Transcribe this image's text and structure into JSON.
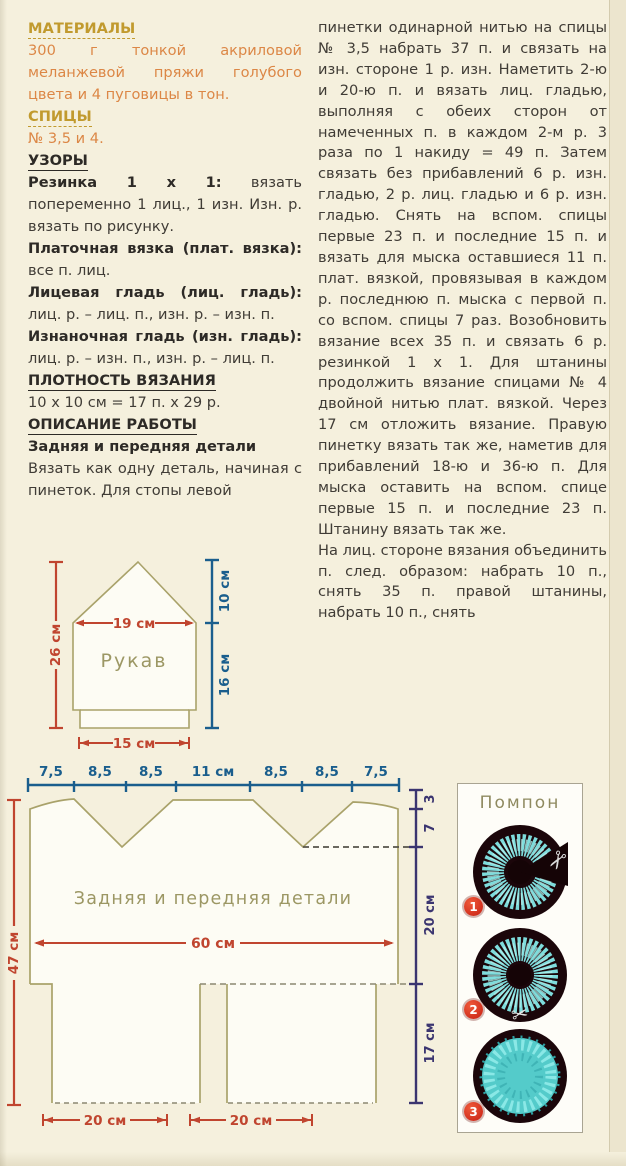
{
  "left_column": {
    "materials": {
      "title": "МАТЕРИАЛЫ",
      "body": "300 г тонкой акриловой меланжевой пряжи голубого цвета и 4 пуговицы в тон."
    },
    "needles": {
      "title": "СПИЦЫ",
      "body": "№ 3,5 и 4."
    },
    "patterns": {
      "title": "УЗОРЫ",
      "items": [
        {
          "term": "Резинка 1 х 1:",
          "rest": "вязать попеременно 1 лиц., 1 изн. Изн. р. вязать по рисунку."
        },
        {
          "term": "Платочная вязка (плат. вязка):",
          "rest": "все п. лиц."
        },
        {
          "term": "Лицевая гладь (лиц. гладь):",
          "rest": "лиц. р. – лиц. п., изн. р. – изн. п."
        },
        {
          "term": "Изнаночная гладь (изн. гладь):",
          "rest": "лиц. р. – изн. п., изн. р. – лиц. п."
        }
      ]
    },
    "gauge": {
      "title": "ПЛОТНОСТЬ ВЯЗАНИЯ",
      "body": "10 х 10 см = 17 п. х 29 р."
    },
    "work": {
      "title": "ОПИСАНИЕ РАБОТЫ",
      "subtitle": "Задняя и передняя детали",
      "body": "Вязать как одну деталь, начиная с пинеток. Для стопы левой"
    }
  },
  "right_column": {
    "para1": "пинетки одинарной нитью на спицы № 3,5 набрать 37 п. и связать на изн. стороне 1 р. изн. Наметить 2-ю и 20-ю п. и вязать лиц. гладью, выполняя с обеих сторон от намеченных п. в каждом 2-м р. 3 раза по 1 накиду = 49 п. Затем связать без прибавлений 6 р. изн. гладью, 2 р. лиц. гладью и 6 р. изн. гладью. Снять на вспом. спицы первые 23 п. и последние 15 п. и вязать для мыска оставшиеся 11 п. плат. вязкой, провязывая в каждом р. последнюю п. мыска с первой п. со вспом. спицы 7 раз. Возобновить вязание всех 35 п. и связать 6 р. резинкой 1 х 1. Для штанины продолжить вязание спицами № 4 двойной нитью плат. вязкой. Через 17 см отложить вязание. Правую пинетку вязать так же, наметив для прибавлений 18-ю и 36-ю п. Для мыска оставить на вспом. спице первые 15 п. и последние 23 п. Штанину вязать так же.",
    "para2": "На лиц. стороне вязания объединить п. след. образом: набрать 10 п., снять 35 п. правой штанины, набрать 10 п., снять"
  },
  "sleeve_diagram": {
    "label": "Рукав",
    "height_total": "26 см",
    "top_width": "19 см",
    "cap_height": "10 см",
    "lower_height": "16 см",
    "cuff_width": "15 см"
  },
  "body_diagram": {
    "label": "Задняя и передняя детали",
    "top_segments": [
      "7,5",
      "8,5",
      "8,5",
      "11 см",
      "8,5",
      "8,5",
      "7,5"
    ],
    "left_height": "47 см",
    "chest_width": "60 см",
    "right_marks": [
      "3",
      "7",
      "20 см",
      "17 см"
    ],
    "leg_width": "20 см"
  },
  "pompon_panel": {
    "title": "Помпон",
    "steps": [
      {
        "num": "1"
      },
      {
        "num": "2"
      },
      {
        "num": "3"
      }
    ],
    "scissors_glyph": "✂"
  },
  "colors": {
    "page_bg": "#f5f0dd",
    "gold_header": "#c19a2e",
    "orange_text": "#dc8746",
    "measure_red": "#c0452f",
    "measure_blue": "#1a5e8d",
    "measure_indigo": "#3b3570",
    "outline_olive": "#a9a26a",
    "yarn_turquoise": "#63d1d1"
  }
}
